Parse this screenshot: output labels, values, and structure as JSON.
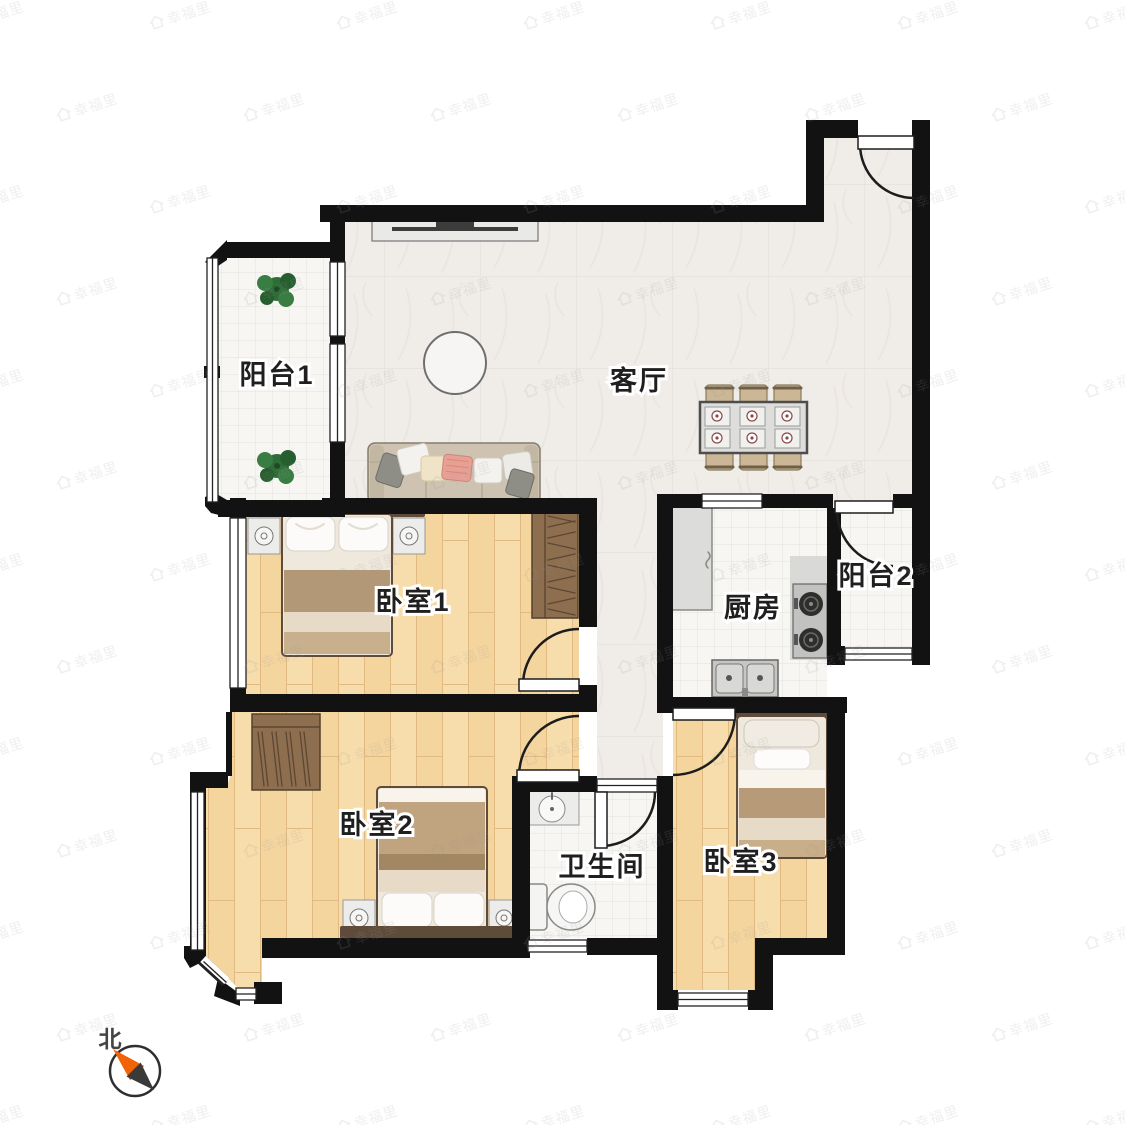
{
  "watermark": {
    "text": "幸福里"
  },
  "compass": {
    "north": "北"
  },
  "rooms": {
    "balcony1": {
      "label": "阳台1"
    },
    "living": {
      "label": "客厅"
    },
    "bedroom1": {
      "label": "卧室1"
    },
    "kitchen": {
      "label": "厨房"
    },
    "balcony2": {
      "label": "阳台2"
    },
    "bedroom2": {
      "label": "卧室2"
    },
    "bathroom": {
      "label": "卫生间"
    },
    "bedroom3": {
      "label": "卧室3"
    }
  },
  "colors": {
    "wall": "#121212",
    "wood_floor": "#f4d59e",
    "marble_floor": "#f0ede9",
    "tile_floor": "#f7f6f3",
    "compass_orange": "#f26207",
    "compass_dark": "#3a3a38",
    "furniture_wood": "#8d6e4f",
    "headboard": "#5f4b39"
  }
}
